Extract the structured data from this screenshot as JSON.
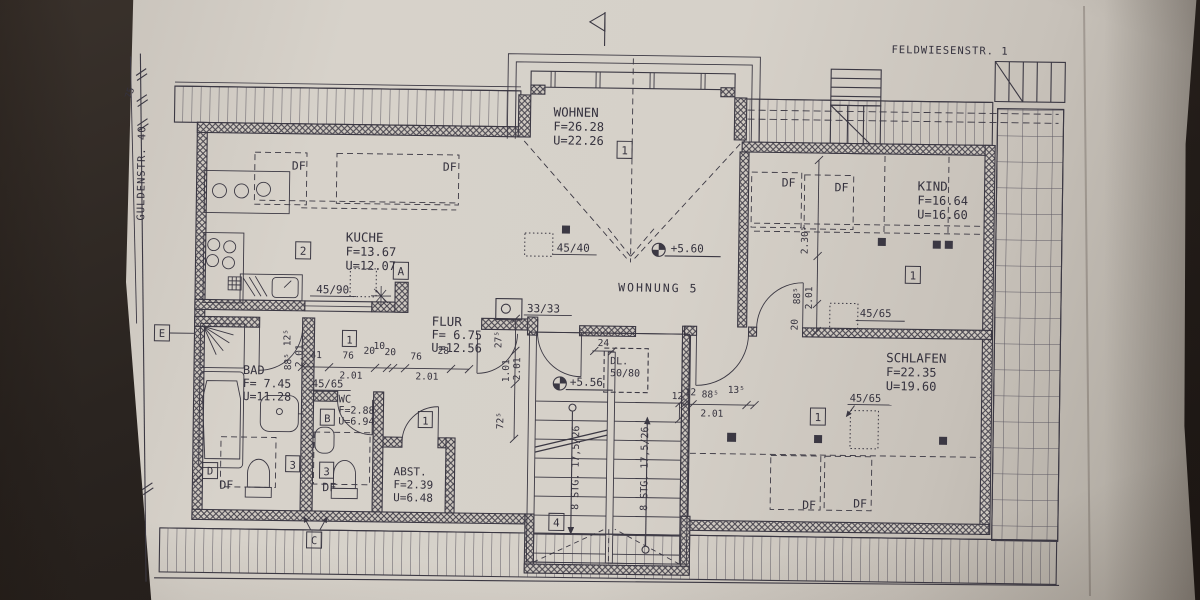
{
  "streets": {
    "top": "FELDWIESENSTR. 1",
    "left": "GULDENSTR. 40",
    "left_dim": "75"
  },
  "unit": {
    "label": "WOHNUNG 5"
  },
  "rooms": {
    "wohnen": {
      "name": "WOHNEN",
      "area": "F=26.28",
      "perimeter": "U=22.26"
    },
    "kueche": {
      "name": "KUCHE",
      "area": "F=13.67",
      "perimeter": "U=12.07"
    },
    "kind": {
      "name": "KIND",
      "area": "F=16.64",
      "perimeter": "U=16.60"
    },
    "schlafen": {
      "name": "SCHLAFEN",
      "area": "F=22.35",
      "perimeter": "U=19.60"
    },
    "flur": {
      "name": "FLUR",
      "area": "F= 6.75",
      "perimeter": "U=12.56"
    },
    "bad": {
      "name": "BAD",
      "area": "F= 7.45",
      "perimeter": "U=11.28"
    },
    "wc": {
      "name": "WC",
      "area": "F=2.88",
      "perimeter": "U=6.94"
    },
    "abst": {
      "name": "ABST.",
      "area": "F=2.39",
      "perimeter": "U=6.48"
    }
  },
  "levels": {
    "hall": "+5.60",
    "stairwell": "+5.56"
  },
  "stairs": {
    "flight": "8 STG. 17,5/26",
    "hatch_label": "DL.",
    "hatch_size": "50/80"
  },
  "openings": {
    "kitchen_window": "45/90",
    "hall_window": "45/40",
    "chimney": "33/33",
    "roof_window_size": "45/65",
    "roof_window": "DF"
  },
  "dims": {
    "chain": [
      "41",
      "76",
      "20",
      "10",
      "20",
      "76",
      "28"
    ],
    "chain_total": "2.01",
    "bad_door": [
      "12⁵",
      "88⁵",
      "2.01"
    ],
    "schlafen_door": [
      "12",
      "88⁵",
      "13⁵",
      "2.01"
    ],
    "kind_wall": [
      "2.30⁵",
      "88⁵",
      "2.01",
      "20"
    ],
    "flur_wall": [
      "27⁵",
      "1.01",
      "2.01",
      "72⁵"
    ],
    "stair_top": "24",
    "stair_side": "12"
  },
  "refs": {
    "r1": "1",
    "r2": "2",
    "r3": "3",
    "r4": "4",
    "a": "A",
    "b": "B",
    "c": "C",
    "d": "D",
    "e": "E"
  }
}
